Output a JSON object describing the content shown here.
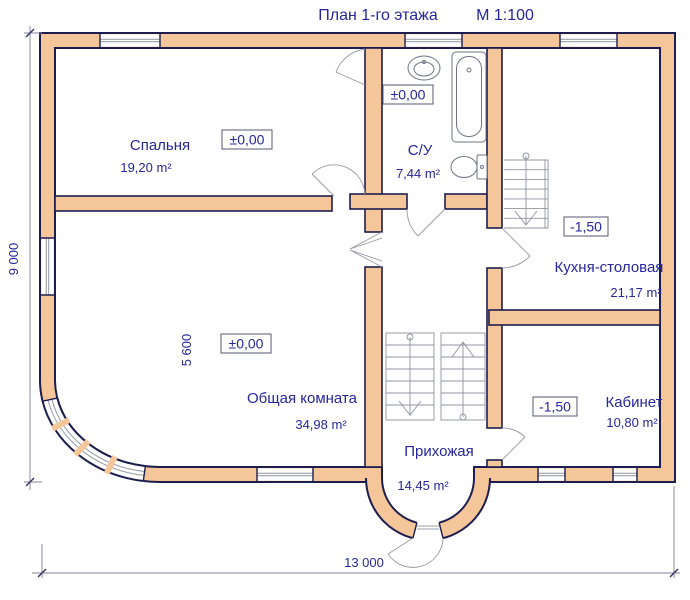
{
  "title": {
    "text": "План 1-го этажа",
    "scale": "М 1:100"
  },
  "rooms": [
    {
      "id": "bedroom",
      "name": "Спальня",
      "area": "19,20 m²",
      "elevation": "±0,00"
    },
    {
      "id": "bathroom",
      "name": "С/У",
      "area": "7,44 m²",
      "elevation": "±0,00"
    },
    {
      "id": "kitchen",
      "name": "Кухня-столовая",
      "area": "21,17 m²",
      "elevation": "-1,50"
    },
    {
      "id": "living",
      "name": "Общая комната",
      "area": "34,98 m²",
      "elevation": "±0,00"
    },
    {
      "id": "study",
      "name": "Кабинет",
      "area": "10,80 m²",
      "elevation": "-1,50"
    },
    {
      "id": "hall",
      "name": "Прихожая",
      "area": "14,45 m²"
    }
  ],
  "dimensions": {
    "height_total": "9 000",
    "width_total": "13 000",
    "living_width": "5 600"
  },
  "fixtures": [
    "sink",
    "bathtub",
    "toilet",
    "kitchen-staircase",
    "hall-staircase-down",
    "hall-staircase-up"
  ],
  "colors": {
    "wall_fill": "#F6C69B",
    "wall_outline": "#1D1D4F",
    "label_text": "#26269E",
    "glazing": "#9AA0A8",
    "dimension_line": "#80809C"
  }
}
